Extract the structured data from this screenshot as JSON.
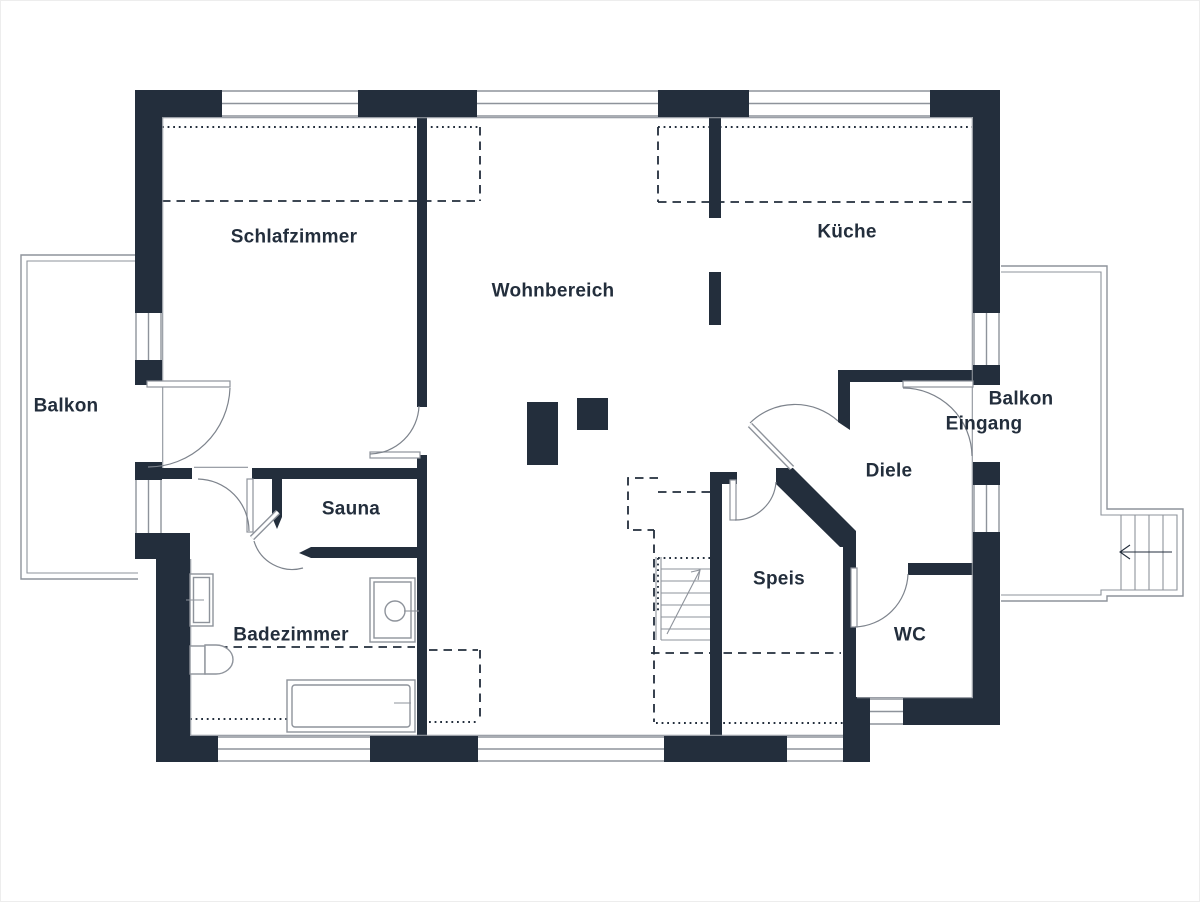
{
  "document": {
    "kind": "architectural floor plan",
    "language": "German"
  },
  "colors": {
    "wall": "#232e3c",
    "thin_line": "#8e939b",
    "background": "#ffffff",
    "text": "#232e3c"
  },
  "rooms": [
    {
      "id": "schlafzimmer",
      "label": "Schlafzimmer"
    },
    {
      "id": "wohnbereich",
      "label": "Wohnbereich"
    },
    {
      "id": "kueche",
      "label": "Küche"
    },
    {
      "id": "balkon-left",
      "label": "Balkon"
    },
    {
      "id": "balkon-right",
      "label": "Balkon"
    },
    {
      "id": "eingang",
      "label": "Eingang"
    },
    {
      "id": "diele",
      "label": "Diele"
    },
    {
      "id": "sauna",
      "label": "Sauna"
    },
    {
      "id": "speis",
      "label": "Speis"
    },
    {
      "id": "wc",
      "label": "WC"
    },
    {
      "id": "badezimmer",
      "label": "Badezimmer"
    }
  ],
  "plan_elements": [
    "exterior-walls-with-windows",
    "interior-walls",
    "door-swing-arcs",
    "entrance-door-east-wall",
    "balcony-left-railing",
    "balcony-right-railing",
    "exterior-staircase-east",
    "interior-staircase-with-arrow",
    "chimney-blocks",
    "roof-overhang-dashed-lines",
    "upper-floor-dotted-lines",
    "bathtub",
    "toilet",
    "washbasin",
    "vanity-sink"
  ]
}
